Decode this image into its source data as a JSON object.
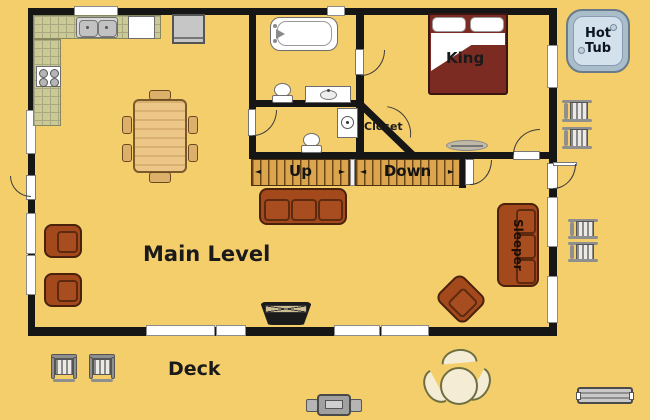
{
  "floor_plan": {
    "level_label": "Main Level",
    "deck_label": "Deck",
    "bedroom": {
      "bed_label": "King"
    },
    "closet_label": "Closet",
    "stairs": {
      "up": "Up",
      "down": "Down",
      "arrow_left": "◄",
      "arrow_right": "►"
    },
    "living": {
      "sleeper_label": "Sleeper"
    },
    "hot_tub": {
      "line1": "Hot",
      "line2": "Tub"
    },
    "colors": {
      "background": "#F5CE6C",
      "wall": "#161616",
      "window": "#FFFFFF",
      "furniture_brown": "#A3491C",
      "bed_red": "#7C2B23",
      "stair_wood": "#DAA54D",
      "counter_tile": "#CBCA97",
      "hot_tub_rim": "#A9BDCB",
      "hot_tub_water": "#D3E1ED",
      "deck_furniture_gray": "#8F8F8F",
      "patio_set_cream": "#F4ECD4",
      "text": "#1A1A1A"
    }
  }
}
